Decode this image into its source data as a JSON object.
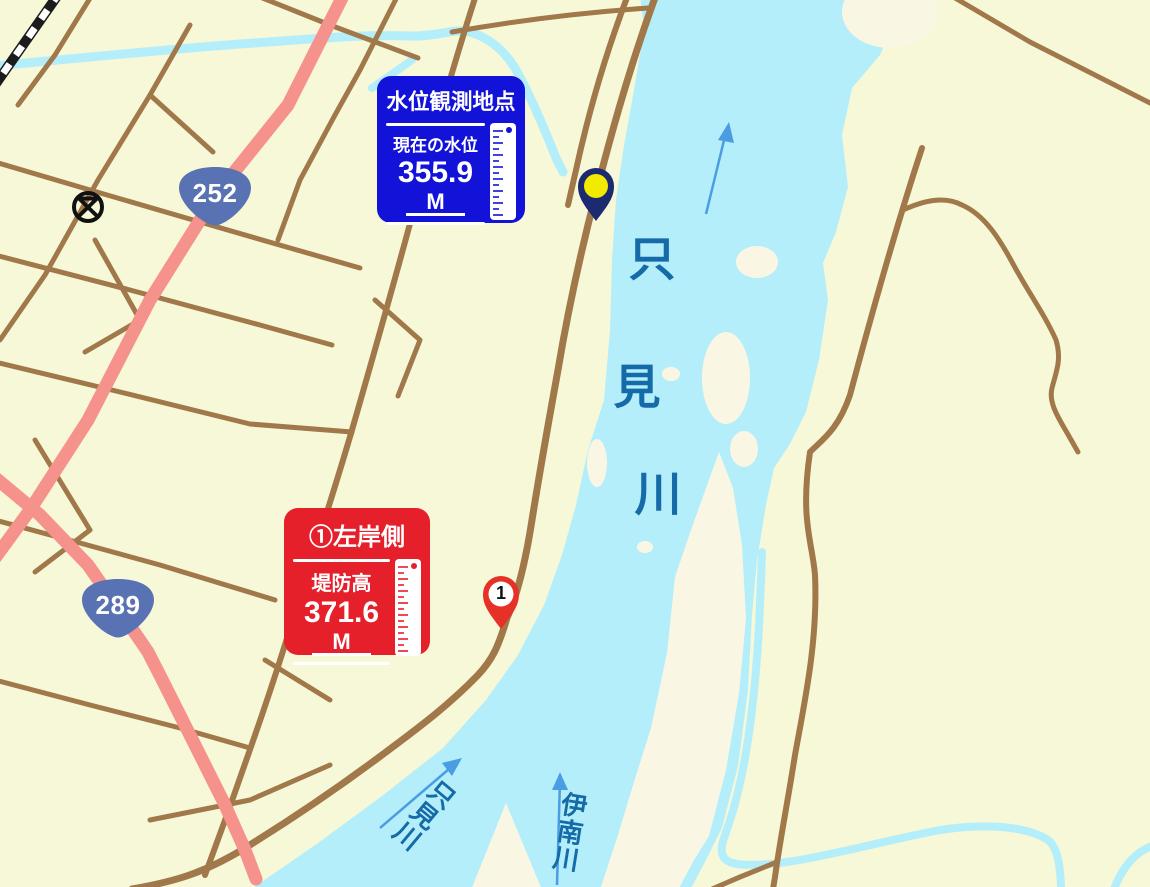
{
  "info_boxes": {
    "water_level": {
      "title": "水位観測地点",
      "label": "現在の水位",
      "value": "355.9",
      "unit": "M"
    },
    "levee": {
      "title": "①左岸側",
      "label": "堤防高",
      "value": "371.6",
      "unit": "M"
    }
  },
  "route_badges": {
    "r252": "252",
    "r289": "289"
  },
  "river_labels": {
    "main_chars": [
      "只",
      "見",
      "川"
    ],
    "tadami_flow": "只見川",
    "ina_flow": "伊南川"
  },
  "markers": {
    "levee_pin_number": "1"
  },
  "map_symbols": {
    "police_station": "circled-x"
  },
  "colors": {
    "land": "#f6f8d8",
    "sandbar": "#f9f7e3",
    "water": "#b5eefb",
    "road": "#a1784a",
    "highway": "#f6928c",
    "water_level_box": "#1212d8",
    "levee_box": "#e6202a",
    "flow_arrow": "#4a9de2",
    "river_label": "#156ba8",
    "badge": "#5872b3",
    "pin_navy": "#1c2a70",
    "pin_yellow": "#f2ea00",
    "pin_red": "#e63128"
  }
}
